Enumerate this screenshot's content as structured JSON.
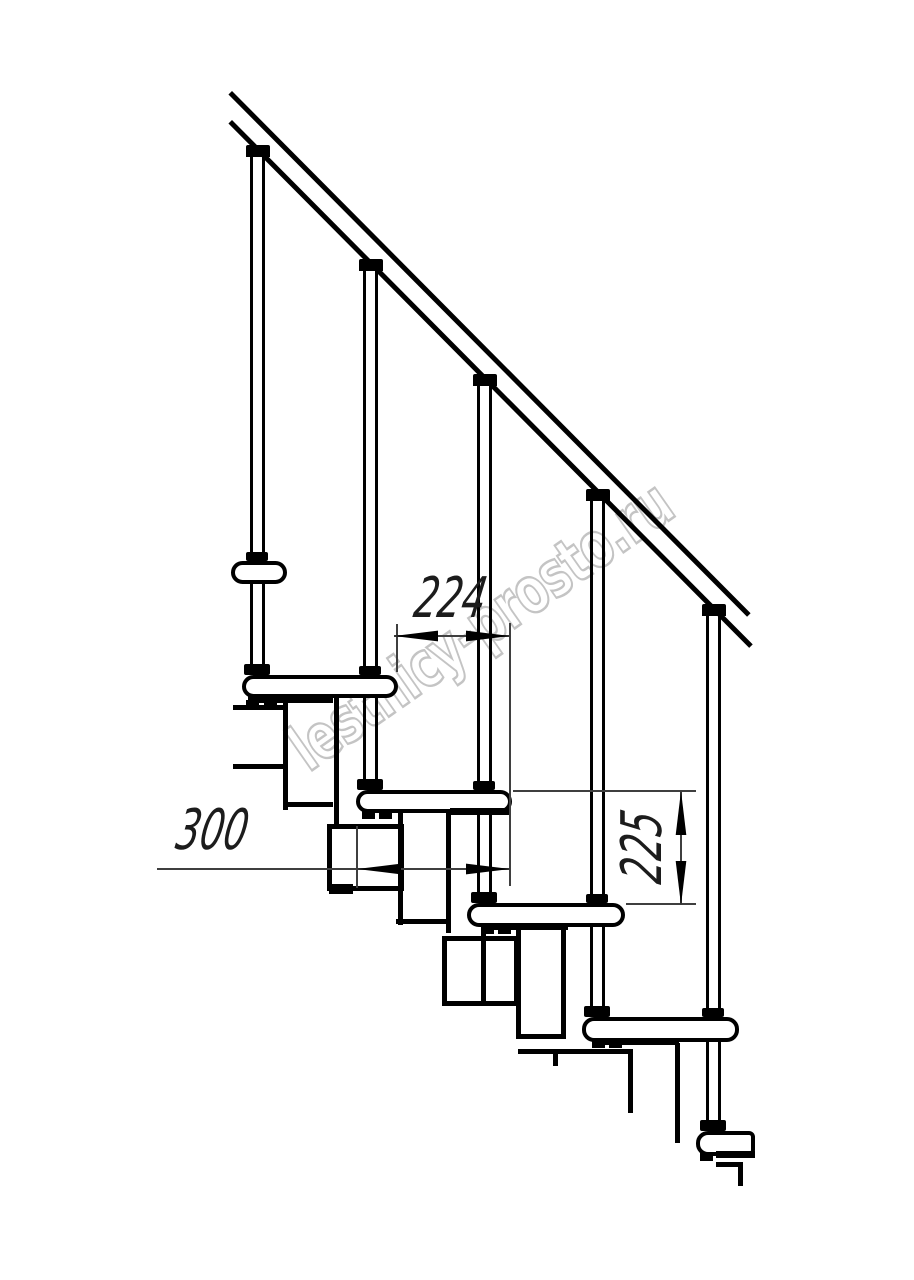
{
  "watermark": {
    "text": "lestnicy-prosto.ru"
  },
  "dimensions": {
    "run_label": "224",
    "depth_label": "300",
    "rise_label": "225"
  },
  "colors": {
    "drawing_line": "#000000",
    "dimension_line": "#3f3f3f",
    "watermark_outline": "#c4c4c4",
    "background": "#ffffff"
  }
}
